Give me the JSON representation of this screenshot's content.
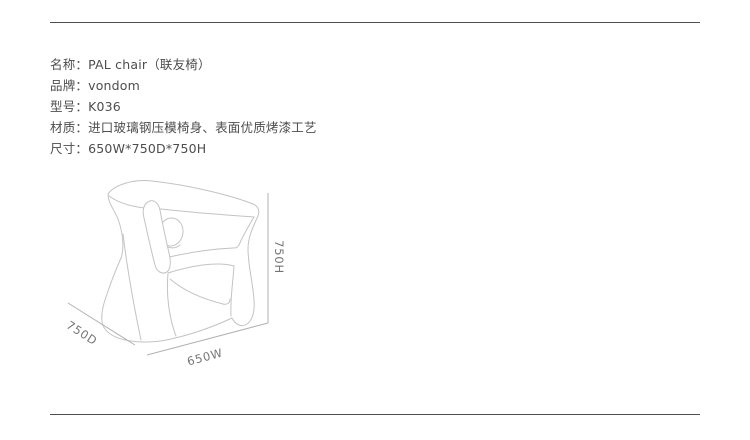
{
  "page": {
    "background_color": "#ffffff",
    "divider_color": "#4f4f4f"
  },
  "product_specs": {
    "colon": "：",
    "text_color": "#4d4d4d",
    "items": [
      {
        "label": "名称",
        "value": "PAL chair（联友椅）"
      },
      {
        "label": "品牌",
        "value": "vondom"
      },
      {
        "label": "型号",
        "value": "K036"
      },
      {
        "label": "材质",
        "value": "进口玻璃钢压模椅身、表面优质烤漆工艺"
      },
      {
        "label": "尺寸",
        "value": "650W*750D*750H"
      }
    ]
  },
  "diagram": {
    "subject": "chair-line-drawing",
    "stroke_color": "#c3c3c3",
    "dimension_line_color": "#b2b2b2",
    "dimension_label_color": "#757575",
    "dimensions": {
      "height": "750H",
      "depth": "750D",
      "width": "650W"
    }
  }
}
